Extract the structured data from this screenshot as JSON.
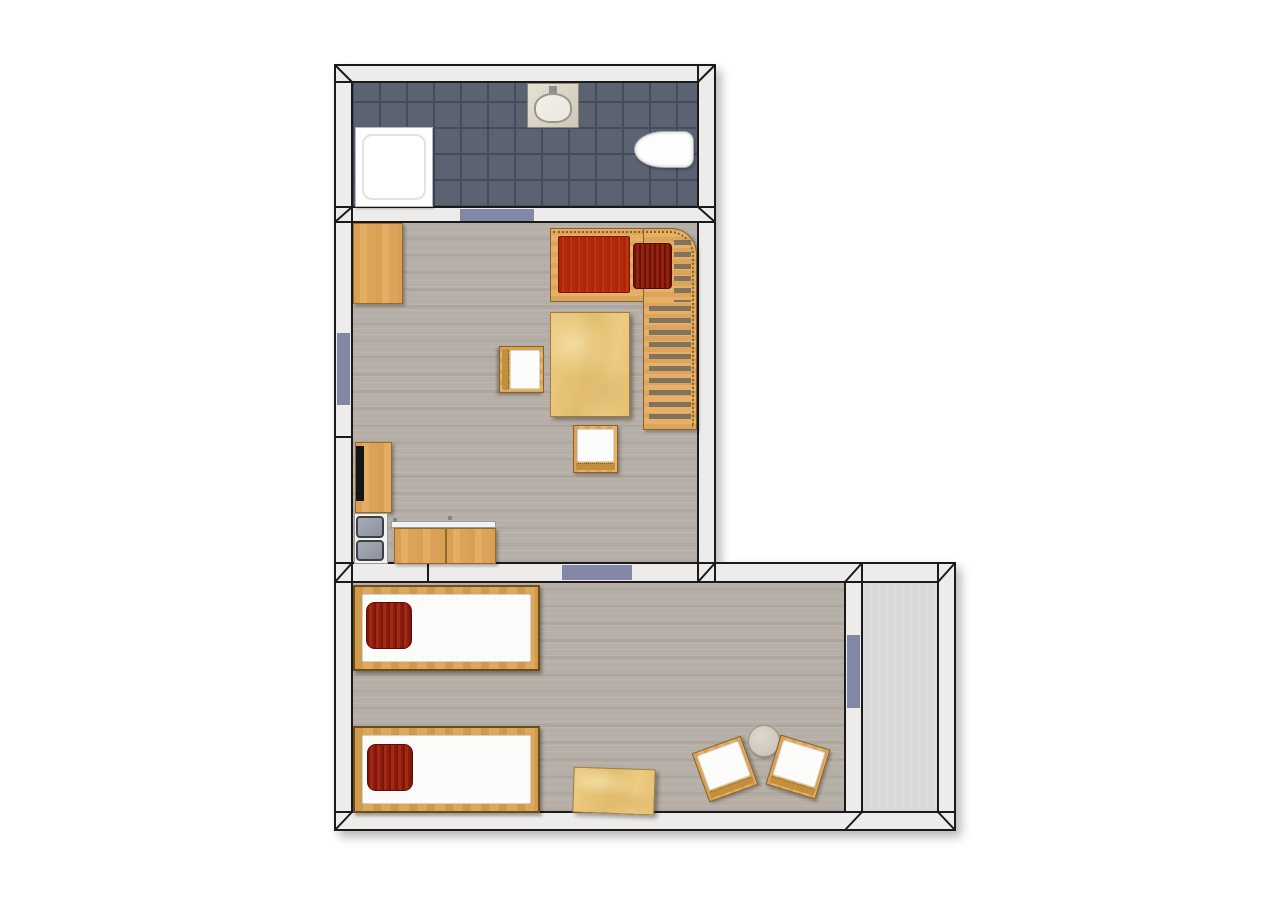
{
  "canvas": {
    "w": 1280,
    "h": 900,
    "bg": "#ffffff"
  },
  "palette": {
    "wall_fill": "#edecea",
    "wall_line": "#1a1a1a",
    "door_marker": "#8187a5",
    "tile_base": "#5b6271",
    "tile_line": "#454c5c",
    "floor_wood": "#b6afa7",
    "floor_hall": "#d8d9d8",
    "wood_line": "#936b2f",
    "wood_light": "#e0a75e",
    "plywood": "#e9c87e",
    "red_mattress": "#b22a0c",
    "red_pillow": "#8c1d0e",
    "cushion_white": "#fcfcfb",
    "appliance_gray": "#979eaa",
    "round_table_top": "#d0c9bc"
  },
  "rooms": [
    {
      "name": "bathroom"
    },
    {
      "name": "living-room"
    },
    {
      "name": "bedroom"
    },
    {
      "name": "hallway"
    }
  ],
  "floors": [
    {
      "type": "floor-tile",
      "name": "bathroom-floor",
      "x": 352,
      "y": 82,
      "w": 346,
      "h": 125
    },
    {
      "type": "floor-wood",
      "name": "living-room-floor",
      "x": 352,
      "y": 222,
      "w": 346,
      "h": 341
    },
    {
      "type": "floor-wood",
      "name": "bedroom-floor",
      "x": 352,
      "y": 582,
      "w": 493,
      "h": 230
    },
    {
      "type": "floor-plain",
      "name": "hallway-floor",
      "x": 862,
      "y": 582,
      "w": 76,
      "h": 230
    }
  ],
  "walls": [
    {
      "name": "left-wall",
      "x": 335,
      "y": 65,
      "w": 17,
      "h": 765
    },
    {
      "name": "bathroom-top-wall",
      "x": 335,
      "y": 65,
      "w": 380,
      "h": 17
    },
    {
      "name": "right-wall-upper",
      "x": 698,
      "y": 65,
      "w": 17,
      "h": 517
    },
    {
      "name": "bathroom-living-wall",
      "x": 335,
      "y": 207,
      "w": 380,
      "h": 15
    },
    {
      "name": "bedroom-top-wall",
      "x": 335,
      "y": 563,
      "w": 620,
      "h": 19
    },
    {
      "name": "bedroom-right-wall",
      "x": 938,
      "y": 563,
      "w": 17,
      "h": 267
    },
    {
      "name": "bedroom-bottom-wall",
      "x": 335,
      "y": 812,
      "w": 620,
      "h": 18
    },
    {
      "name": "hallway-divider-wall",
      "x": 845,
      "y": 582,
      "w": 17,
      "h": 230
    }
  ],
  "joints": [
    {
      "name": "miter-bathroom-tl",
      "x1": 335,
      "y1": 65,
      "x2": 352,
      "y2": 82
    },
    {
      "name": "miter-bathroom-tr",
      "x1": 715,
      "y1": 65,
      "x2": 698,
      "y2": 82
    },
    {
      "name": "miter-bath-living-left",
      "x1": 335,
      "y1": 222,
      "x2": 352,
      "y2": 207
    },
    {
      "name": "miter-bath-living-right",
      "x1": 715,
      "y1": 222,
      "x2": 698,
      "y2": 207
    },
    {
      "name": "seam-bath-living-left",
      "x1": 352,
      "y1": 207,
      "x2": 352,
      "y2": 222
    },
    {
      "name": "seam-left-wall",
      "x1": 335,
      "y1": 437,
      "x2": 352,
      "y2": 437
    },
    {
      "name": "miter-living-bedroom-left",
      "x1": 335,
      "y1": 582,
      "x2": 352,
      "y2": 563
    },
    {
      "name": "seam-living-bedroom-left",
      "x1": 352,
      "y1": 563,
      "x2": 352,
      "y2": 582
    },
    {
      "name": "seam-kitchen-wall",
      "x1": 428,
      "y1": 563,
      "x2": 428,
      "y2": 582
    },
    {
      "name": "miter-living-right-junction",
      "x1": 698,
      "y1": 582,
      "x2": 715,
      "y2": 563
    },
    {
      "name": "seam-living-right-inner",
      "x1": 698,
      "y1": 563,
      "x2": 698,
      "y2": 582
    },
    {
      "name": "seam-living-right-outer",
      "x1": 715,
      "y1": 563,
      "x2": 715,
      "y2": 582
    },
    {
      "name": "miter-divider-top",
      "x1": 845,
      "y1": 582,
      "x2": 862,
      "y2": 563
    },
    {
      "name": "seam-divider-top",
      "x1": 862,
      "y1": 563,
      "x2": 862,
      "y2": 582
    },
    {
      "name": "miter-bedroom-tr",
      "x1": 938,
      "y1": 582,
      "x2": 955,
      "y2": 563
    },
    {
      "name": "miter-bedroom-bl",
      "x1": 335,
      "y1": 830,
      "x2": 352,
      "y2": 812
    },
    {
      "name": "miter-divider-bottom",
      "x1": 845,
      "y1": 830,
      "x2": 862,
      "y2": 812
    },
    {
      "name": "miter-bedroom-br",
      "x1": 938,
      "y1": 812,
      "x2": 955,
      "y2": 830
    }
  ],
  "openings": [
    {
      "name": "bathroom-door",
      "x": 460,
      "y": 209,
      "w": 74,
      "h": 12
    },
    {
      "name": "living-room-window",
      "x": 337,
      "y": 333,
      "w": 13,
      "h": 72
    },
    {
      "name": "living-bedroom-door",
      "x": 562,
      "y": 565,
      "w": 70,
      "h": 15
    },
    {
      "name": "hallway-door",
      "x": 847,
      "y": 635,
      "w": 13,
      "h": 73
    }
  ],
  "furniture": [
    {
      "type": "shower",
      "name": "shower-tray",
      "x": 355,
      "y": 127,
      "w": 78,
      "h": 80
    },
    {
      "type": "sink",
      "name": "bathroom-sink",
      "x": 527,
      "y": 83,
      "w": 52,
      "h": 45
    },
    {
      "type": "toilet",
      "name": "toilet",
      "x": 634,
      "y": 131,
      "w": 60,
      "h": 37
    },
    {
      "type": "wood",
      "name": "desk",
      "x": 353,
      "y": 223,
      "w": 50,
      "h": 81
    },
    {
      "type": "bench-top",
      "name": "corner-bench-seat",
      "x": 550,
      "y": 228,
      "w": 94,
      "h": 74
    },
    {
      "type": "bench-side",
      "name": "corner-bench-side",
      "x": 643,
      "y": 228,
      "w": 54,
      "h": 202
    },
    {
      "type": "slats",
      "name": "corner-bench-slats-top",
      "x": 674,
      "y": 240,
      "w": 17,
      "h": 62
    },
    {
      "type": "slats",
      "name": "corner-bench-slats",
      "x": 649,
      "y": 306,
      "w": 42,
      "h": 118
    },
    {
      "type": "mattress",
      "name": "bench-mattress",
      "x": 558,
      "y": 236,
      "w": 72,
      "h": 57
    },
    {
      "type": "cushion-striped",
      "name": "bench-cushion",
      "x": 633,
      "y": 243,
      "w": 39,
      "h": 46
    },
    {
      "type": "plywood",
      "name": "living-table",
      "x": 550,
      "y": 312,
      "w": 80,
      "h": 105
    },
    {
      "type": "chair",
      "name": "living-chair-1",
      "x": 498,
      "y": 347,
      "w": 47,
      "h": 45,
      "rot": 90
    },
    {
      "type": "chair",
      "name": "living-chair-2",
      "x": 573,
      "y": 425,
      "w": 45,
      "h": 48
    },
    {
      "type": "wood",
      "name": "kitchen-cabinet",
      "x": 355,
      "y": 442,
      "w": 37,
      "h": 71
    },
    {
      "type": "black-panel",
      "name": "kitchen-tv-panel",
      "x": 356,
      "y": 446,
      "w": 8,
      "h": 55
    },
    {
      "type": "white-base",
      "name": "appliance-base",
      "x": 354,
      "y": 513,
      "w": 34,
      "h": 51
    },
    {
      "type": "gray-panel",
      "name": "appliance-door-top",
      "x": 356,
      "y": 516,
      "w": 28,
      "h": 22
    },
    {
      "type": "gray-panel",
      "name": "appliance-door-bottom",
      "x": 356,
      "y": 540,
      "w": 28,
      "h": 21
    },
    {
      "type": "white-base",
      "name": "counter-back-edge",
      "x": 391,
      "y": 521,
      "w": 105,
      "h": 7
    },
    {
      "type": "wood",
      "name": "counter-left",
      "x": 394,
      "y": 528,
      "w": 52,
      "h": 36
    },
    {
      "type": "wood",
      "name": "counter-right",
      "x": 446,
      "y": 528,
      "w": 50,
      "h": 36
    },
    {
      "type": "knob",
      "name": "counter-knob-1",
      "x": 393,
      "y": 518,
      "w": 4,
      "h": 4
    },
    {
      "type": "knob",
      "name": "counter-knob-2",
      "x": 448,
      "y": 516,
      "w": 4,
      "h": 4
    },
    {
      "type": "bed",
      "name": "bed-1",
      "x": 353,
      "y": 585,
      "w": 187,
      "h": 86
    },
    {
      "type": "pillow",
      "name": "bed-1-pillow",
      "x": 366,
      "y": 602,
      "w": 46,
      "h": 47
    },
    {
      "type": "bed",
      "name": "bed-2",
      "x": 353,
      "y": 726,
      "w": 187,
      "h": 87
    },
    {
      "type": "pillow",
      "name": "bed-2-pillow",
      "x": 367,
      "y": 744,
      "w": 46,
      "h": 47
    },
    {
      "type": "plywood",
      "name": "bedroom-table",
      "x": 573,
      "y": 768,
      "w": 82,
      "h": 46,
      "rot": 2
    },
    {
      "type": "round-table",
      "name": "coffee-table",
      "x": 748,
      "y": 725,
      "w": 32,
      "h": 32
    },
    {
      "type": "chair",
      "name": "bedroom-chair-1",
      "x": 699,
      "y": 743,
      "w": 52,
      "h": 52,
      "rot": -20
    },
    {
      "type": "chair",
      "name": "bedroom-chair-2",
      "x": 772,
      "y": 741,
      "w": 52,
      "h": 52,
      "rot": 17
    }
  ]
}
